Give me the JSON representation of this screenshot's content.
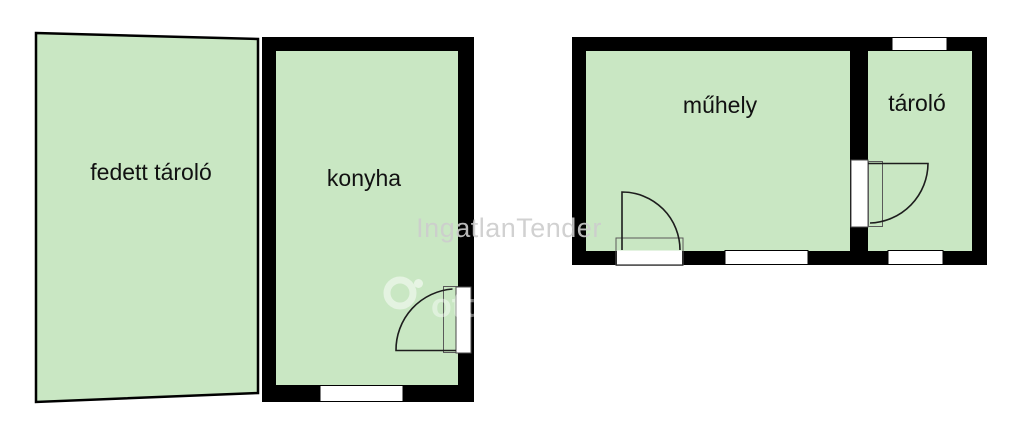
{
  "colors": {
    "room_fill": "#c9e7c3",
    "wall": "#000000",
    "opening_fill": "#ffffff",
    "label_text": "#111111",
    "watermark_text": "#cdcdcd",
    "watermark_logo": "#ffffff"
  },
  "rooms": {
    "fedett_tarolo": {
      "label": "fedett tároló"
    },
    "konyha": {
      "label": "konyha"
    },
    "muhely": {
      "label": "műhely"
    },
    "tarolo": {
      "label": "tároló"
    }
  },
  "watermark": {
    "text": "IngatlanTender",
    "logo_text": "otth"
  }
}
